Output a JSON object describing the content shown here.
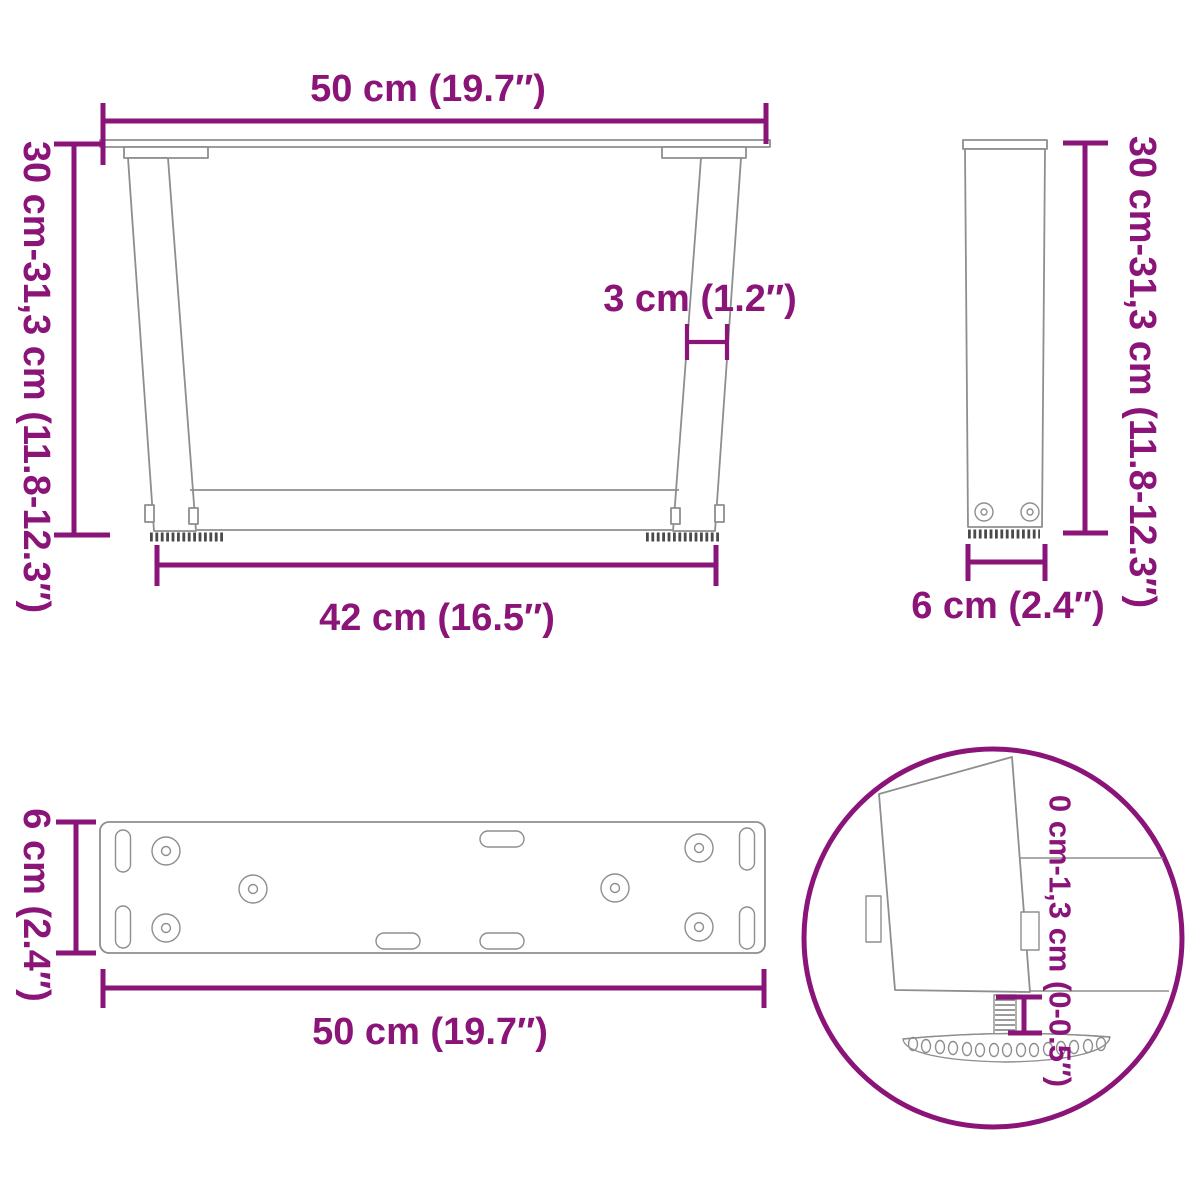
{
  "title": "Table legs dimension diagram",
  "colors": {
    "dimension": "#8a1478",
    "lineart": "#8e8e8e",
    "serration": "#4a4a4a"
  },
  "views": {
    "front": {
      "top_width": "50 cm (19.7″)",
      "height_range": "30 cm-31,3 cm (11.8-12.3″)",
      "bottom_width": "42 cm (16.5″)",
      "profile_thickness": "3 cm (1.2″)"
    },
    "side": {
      "height_range": "30 cm-31,3 cm (11.8-12.3″)",
      "depth": "6 cm (2.4″)"
    },
    "plate": {
      "depth": "6 cm (2.4″)",
      "width": "50 cm (19.7″)"
    },
    "detail": {
      "adjustment_range": "0 cm-1,3 cm (0-0.5″)"
    }
  }
}
